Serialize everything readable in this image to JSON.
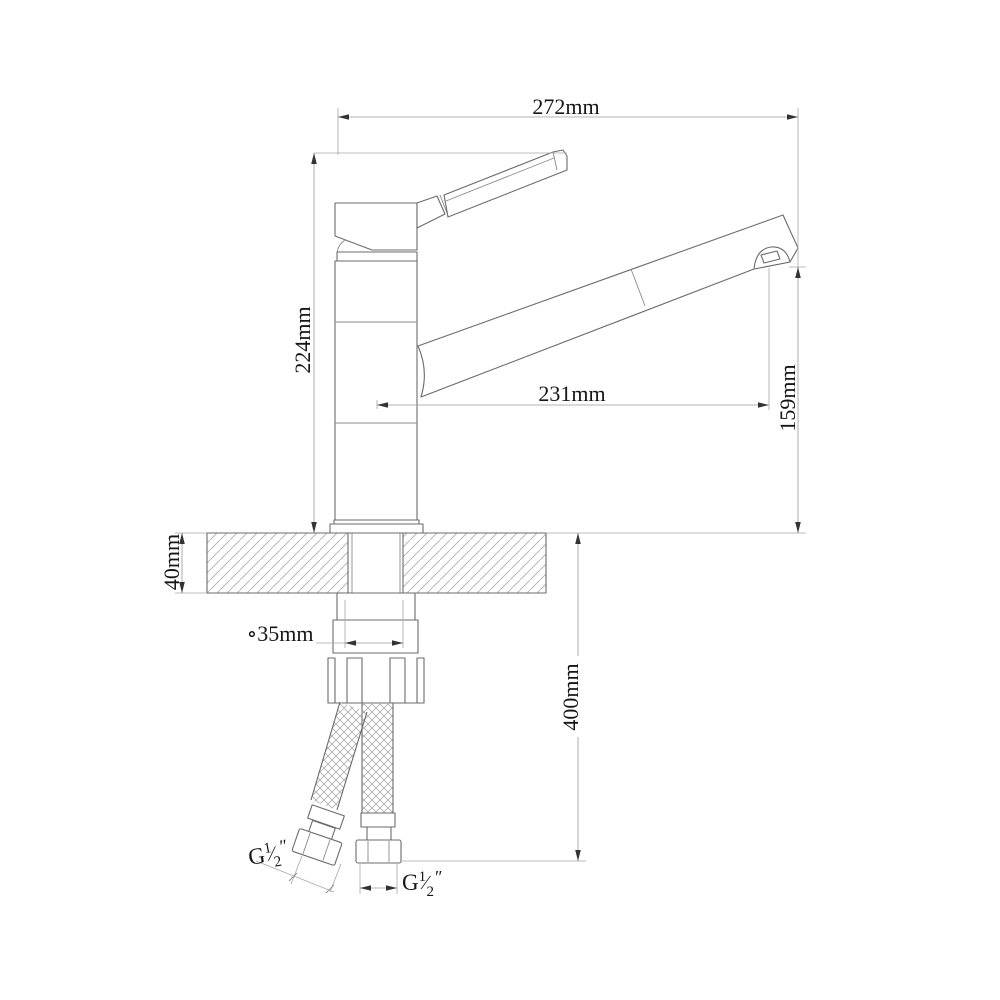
{
  "drawing": {
    "subject": "single-handle kitchen faucet installation dimension drawing",
    "colors": {
      "background": "#ffffff",
      "object_line": "#6b6b6b",
      "dimension_line": "#9a9a9a",
      "hatch_line": "#b8b8b8",
      "text": "#161616",
      "arrowhead": "#333333"
    }
  },
  "dims": {
    "overall_width": "272mm",
    "body_height": "224mm",
    "spout_reach": "231mm",
    "spout_height": "159mm",
    "countertop_thickness": "40mm",
    "hole_diameter": "∘35mm",
    "hose_length": "400mm"
  },
  "threads": {
    "left": {
      "prefix": "G",
      "num": "1",
      "slash": "∕",
      "den": "2",
      "unit": "″"
    },
    "right": {
      "prefix": "G",
      "num": "1",
      "slash": "∕",
      "den": "2",
      "unit": "″"
    }
  }
}
